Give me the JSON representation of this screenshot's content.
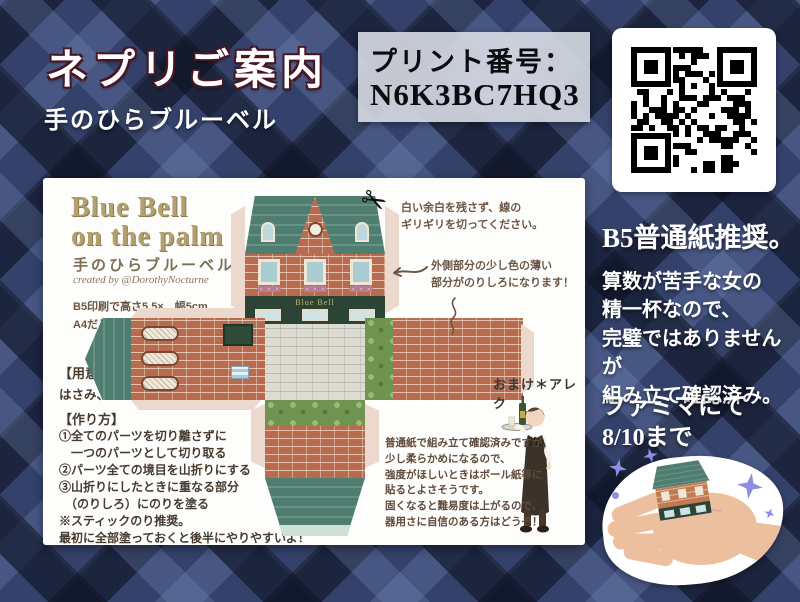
{
  "header": {
    "title": "ネプリご案内",
    "subtitle": "手のひらブルーベル"
  },
  "print_box": {
    "label": "プリント番号：",
    "number": "N6K3BC7HQ3"
  },
  "sheet": {
    "logo_line1": "Blue Bell",
    "logo_line2": "on the palm",
    "logo_sub": "手のひらブルーベル",
    "credit": "created by @DorothyNocturne",
    "size_notes": [
      "B5印刷で高さ5.5×　幅5cm",
      "A4だと計算上1.15倍になります。"
    ],
    "supplies_title": "【用意するもの】",
    "supplies": "はさみ、のり",
    "howto_title": "【作り方】",
    "steps": [
      "①全てのパーツを切り離さずに",
      "　一つのパーツとして切り取る",
      "②パーツ全ての境目を山折りにする",
      "③山折りにしたときに重なる部分",
      "　（のりしろ）にのりを塗る",
      "※スティックのり推奨。",
      "最初に全部塗っておくと後半にやりやすいよ！"
    ],
    "cut_note": [
      "白い余白を残さず、線の",
      "ギリギリを切ってください。"
    ],
    "glue_note": [
      "外側部分の少し色の薄い",
      "部分がのりしろになります！"
    ],
    "bonus_label": "おまけ＊アレク",
    "paper_note": [
      "普通紙で組み立て確認済みですが、",
      "少し柔らかめになるので、",
      "強度がほしいときはボール紙等に",
      "貼るとよさそうです。",
      "固くなると難易度は上がるので、",
      "器用さに自信のある方はどうぞ！"
    ],
    "store_sign": "Blue Bell"
  },
  "right_column": {
    "paper_size": "B5普通紙推奨。",
    "notes": [
      "算数が苦手な女の",
      "精一杯なので、",
      "完璧ではありませんが",
      "組み立て確認済み。"
    ],
    "availability": [
      "ファミマにて",
      "8/10まで"
    ]
  },
  "colors": {
    "accent_teal": "#4f7d70",
    "brick": "#b86b4e",
    "plaid_base": "#33416b",
    "sparkle": "#8f8ce4",
    "title_outline": "#4a1622"
  }
}
